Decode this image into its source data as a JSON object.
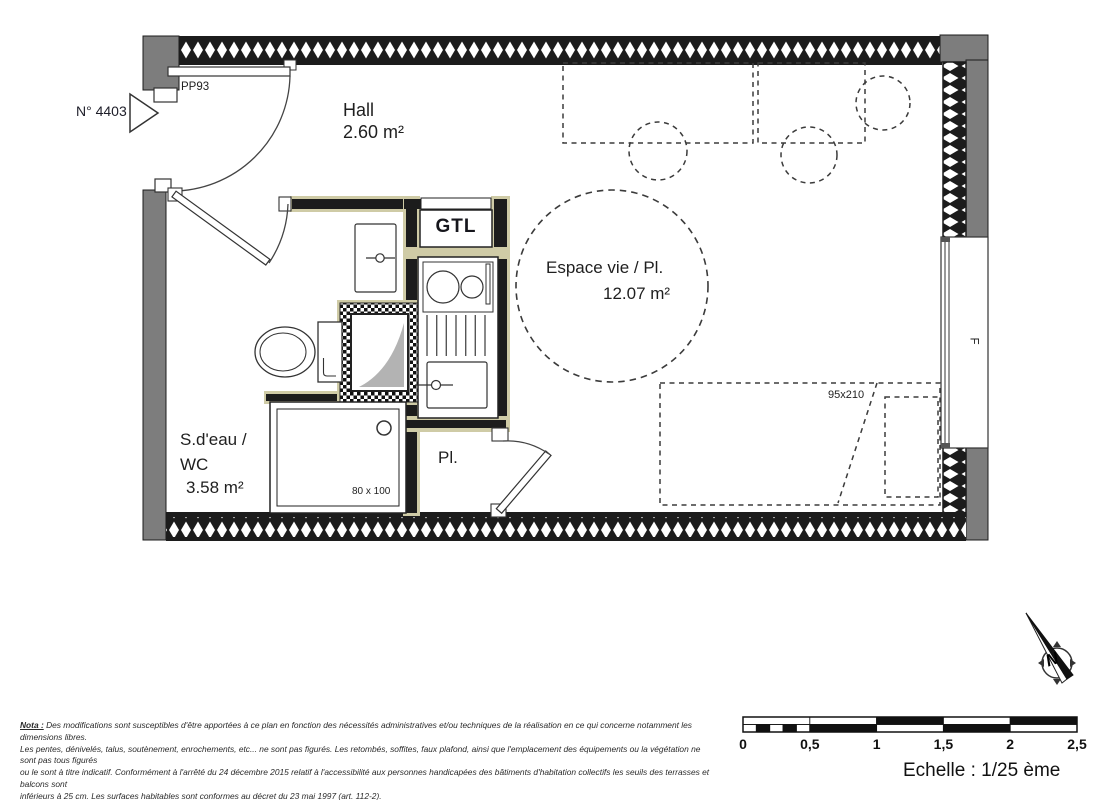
{
  "plan": {
    "unit_marker": {
      "number": "N° 4403"
    },
    "entry_door": {
      "label": "PP93"
    },
    "rooms": {
      "hall": {
        "name": "Hall",
        "area": "2.60 m²"
      },
      "living": {
        "name": "Espace vie / Pl.",
        "area": "12.07 m²"
      },
      "bathroom": {
        "name_line1": "S.d'eau /",
        "name_line2": "WC",
        "area": "3.58 m²"
      },
      "closet": {
        "abbr": "Pl."
      },
      "gtl": {
        "label": "GTL"
      }
    },
    "fixtures": {
      "shower_dimensions": "80 x 100",
      "bed_dimensions": "95x210",
      "window_label": "F"
    }
  },
  "compass": {
    "north_label": "N"
  },
  "scale_bar": {
    "tick_labels": [
      "0",
      "0,5",
      "1",
      "1,5",
      "2",
      "2,5"
    ],
    "caption": "Echelle : 1/25 ème"
  },
  "nota": {
    "label": "Nota :",
    "line1": "Des modifications sont susceptibles d'être apportées à ce plan en fonction des nécessités administratives et/ou techniques de la réalisation en ce qui concerne notamment les dimensions libres.",
    "line2": "Les pentes, dénivelés, talus, soutènement, enrochements, etc... ne sont pas figurés. Les retombés, soffites, faux plafond, ainsi que l'emplacement des équipements ou la végétation ne sont pas tous figurés",
    "line3": "ou le sont à titre indicatif. Conformément à l'arrêté du 24 décembre 2015 relatif à l'accessibilité aux personnes handicapées des bâtiments d'habitation collectifs les seuils des terrasses et balcons sont",
    "line4": "inférieurs à 25 cm. Les surfaces habitables sont conformes au décret du 23 mai 1997 (art. 112-2)."
  },
  "colors": {
    "wall_dark": "#1c1c1c",
    "exterior_gray": "#7d7d7d",
    "trim_khaki": "#cfcba6",
    "duct_gray": "#b3b3b3"
  }
}
